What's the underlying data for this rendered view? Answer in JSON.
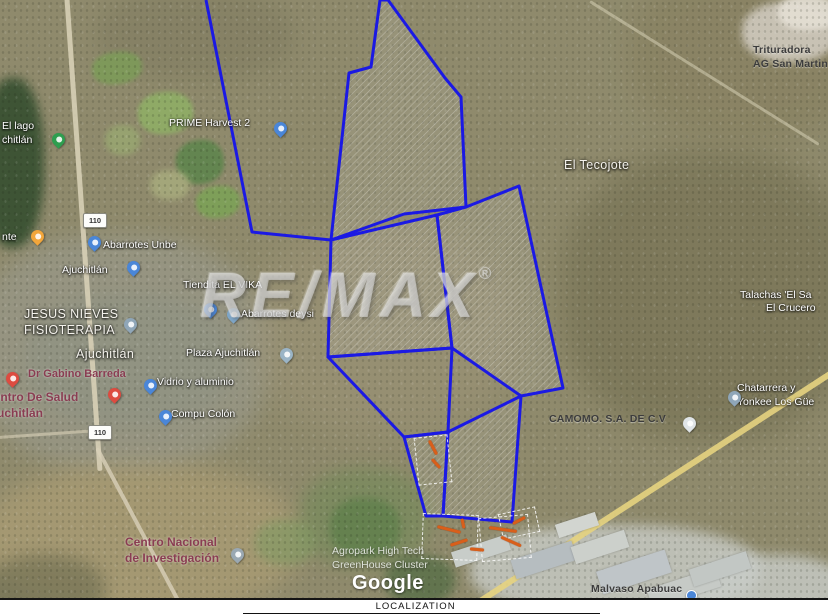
{
  "watermark": {
    "text": "RE/MAX",
    "registered": "®"
  },
  "attribution": {
    "text": "Google"
  },
  "footer": {
    "label": "LOCALIZATION"
  },
  "colors": {
    "parcel_stroke": "#1b19e4",
    "pin_blue": "#4a86d8",
    "pin_green": "#2e9e4f",
    "pin_orange": "#f2a63b",
    "pin_red": "#dd4b40",
    "pin_gray": "#8fa6b8",
    "pin_white": "#dfe4e7",
    "sketch_orange": "#d95f1a"
  },
  "map": {
    "labels": [
      {
        "x": 753,
        "y": 44,
        "type": "dark",
        "lines": [
          "Trituradora",
          "AG San Martin"
        ]
      },
      {
        "x": 169,
        "y": 117,
        "type": "white",
        "lines": [
          "PRIME Harvest 2"
        ]
      },
      {
        "x": 564,
        "y": 157,
        "type": "white-lg",
        "lines": [
          "El Tecojote"
        ]
      },
      {
        "x": 2,
        "y": 120,
        "type": "white",
        "lines": [
          "El lago",
          "chitlán"
        ]
      },
      {
        "x": 2,
        "y": 231,
        "type": "white",
        "lines": [
          "nte"
        ]
      },
      {
        "x": 103,
        "y": 239,
        "type": "white",
        "lines": [
          "Abarrotes Unbe"
        ]
      },
      {
        "x": 62,
        "y": 264,
        "type": "white",
        "lines": [
          "Ajuchitlán"
        ]
      },
      {
        "x": 183,
        "y": 279,
        "type": "white",
        "lines": [
          "Tiendita EL VIKA"
        ]
      },
      {
        "x": 24,
        "y": 306,
        "type": "white-lg",
        "lines": [
          "JESUS NIEVES",
          "FISIOTERAPIA"
        ]
      },
      {
        "x": 241,
        "y": 308,
        "type": "white",
        "lines": [
          "Abarrotes deysi"
        ]
      },
      {
        "x": 76,
        "y": 346,
        "type": "white-lg",
        "lines": [
          "Ajuchitlán"
        ]
      },
      {
        "x": 186,
        "y": 347,
        "type": "white",
        "lines": [
          "Plaza Ajuchitlán"
        ]
      },
      {
        "x": 28,
        "y": 367,
        "type": "maroon",
        "lines": [
          "Dr Gabino Barreda"
        ]
      },
      {
        "x": 157,
        "y": 376,
        "type": "white",
        "lines": [
          "Vidrio y aluminio"
        ]
      },
      {
        "x": -15,
        "y": 390,
        "type": "maroon-lg",
        "lines": [
          "Centro De Salud",
          "Ajuchitlán"
        ]
      },
      {
        "x": 171,
        "y": 408,
        "type": "white",
        "lines": [
          "Compu Colón"
        ]
      },
      {
        "x": 740,
        "y": 289,
        "type": "white",
        "lines": [
          "Talachas 'El Sa"
        ]
      },
      {
        "x": 766,
        "y": 302,
        "type": "white",
        "lines": [
          "El Crucero"
        ]
      },
      {
        "x": 737,
        "y": 382,
        "type": "white",
        "lines": [
          "Chatarrera y",
          "Yonkee Los Güe"
        ]
      },
      {
        "x": 549,
        "y": 413,
        "type": "dark",
        "lines": [
          "CAMOMO. S.A. DE C.V"
        ]
      },
      {
        "x": 125,
        "y": 535,
        "type": "maroon-lg",
        "lines": [
          "Centro Nacional",
          "de Investigación"
        ]
      },
      {
        "x": 332,
        "y": 545,
        "type": "ghost",
        "lines": [
          "Agropark High Tech",
          "GreenHouse Cluster"
        ]
      },
      {
        "x": 591,
        "y": 583,
        "type": "dark",
        "lines": [
          "Malvaso Apabuac"
        ]
      }
    ],
    "pins": [
      {
        "x": 274,
        "y": 122,
        "color": "#4a86d8"
      },
      {
        "x": 52,
        "y": 133,
        "color": "#2e9e4f"
      },
      {
        "x": 31,
        "y": 230,
        "color": "#f2a63b"
      },
      {
        "x": 88,
        "y": 236,
        "color": "#4a86d8"
      },
      {
        "x": 127,
        "y": 261,
        "color": "#4a86d8"
      },
      {
        "x": 204,
        "y": 303,
        "color": "#4a86d8"
      },
      {
        "x": 227,
        "y": 308,
        "color": "#7fa7c9"
      },
      {
        "x": 124,
        "y": 318,
        "color": "#8fa6b8"
      },
      {
        "x": 280,
        "y": 348,
        "color": "#9ab4c6"
      },
      {
        "x": 6,
        "y": 372,
        "color": "#dd4b40"
      },
      {
        "x": 108,
        "y": 388,
        "color": "#dd4b40"
      },
      {
        "x": 144,
        "y": 379,
        "color": "#4a86d8"
      },
      {
        "x": 159,
        "y": 410,
        "color": "#4a86d8"
      },
      {
        "x": 683,
        "y": 417,
        "color": "#dfe4e7"
      },
      {
        "x": 728,
        "y": 391,
        "color": "#8fa6b8"
      },
      {
        "x": 231,
        "y": 548,
        "color": "#9aa8b2"
      },
      {
        "x": 686,
        "y": 590,
        "color": "#4a86d8",
        "kind": "dot"
      }
    ],
    "route_shields": [
      {
        "x": 83,
        "y": 213,
        "text": "110"
      },
      {
        "x": 88,
        "y": 425,
        "text": "110"
      }
    ],
    "parcels": [
      {
        "d": "M206,0 L252,232 L331,240",
        "fill": "none"
      },
      {
        "d": "M380,0 L371,67 L349,73 L331,240 L404,214 L466,207 L461,97 L445,78 L388,0 Z",
        "fill": "hatch"
      },
      {
        "d": "M331,240 L437,215 L452,348 L328,357 Z",
        "fill": "hatch"
      },
      {
        "d": "M437,215 L466,207 L519,186 L563,388 L521,396 L452,348 Z",
        "fill": "hatch"
      },
      {
        "d": "M328,357 L452,348 L448,432 L404,437 Z",
        "fill": "none"
      },
      {
        "d": "M404,437 L448,432 L443,516 L426,516 Z",
        "fill": "hatch"
      },
      {
        "d": "M448,432 L521,396 L512,522 L443,516 Z",
        "fill": "hatch"
      }
    ],
    "sketch_boxes": [
      {
        "x": 416,
        "y": 436,
        "w": 32,
        "h": 46,
        "r": -6
      },
      {
        "x": 422,
        "y": 514,
        "w": 54,
        "h": 44,
        "r": 2
      },
      {
        "x": 480,
        "y": 516,
        "w": 48,
        "h": 42,
        "r": -5
      },
      {
        "x": 500,
        "y": 510,
        "w": 36,
        "h": 24,
        "r": -12
      }
    ],
    "sketch_marks": [
      {
        "x": 425,
        "y": 446,
        "w": 16,
        "r": 62
      },
      {
        "x": 430,
        "y": 462,
        "w": 12,
        "r": 48
      },
      {
        "x": 437,
        "y": 528,
        "w": 24,
        "r": 14
      },
      {
        "x": 450,
        "y": 541,
        "w": 18,
        "r": -18
      },
      {
        "x": 489,
        "y": 528,
        "w": 28,
        "r": 8
      },
      {
        "x": 500,
        "y": 540,
        "w": 22,
        "r": 24
      },
      {
        "x": 512,
        "y": 519,
        "w": 14,
        "r": -28
      },
      {
        "x": 458,
        "y": 522,
        "w": 10,
        "r": 78
      },
      {
        "x": 470,
        "y": 548,
        "w": 14,
        "r": 5
      }
    ]
  }
}
